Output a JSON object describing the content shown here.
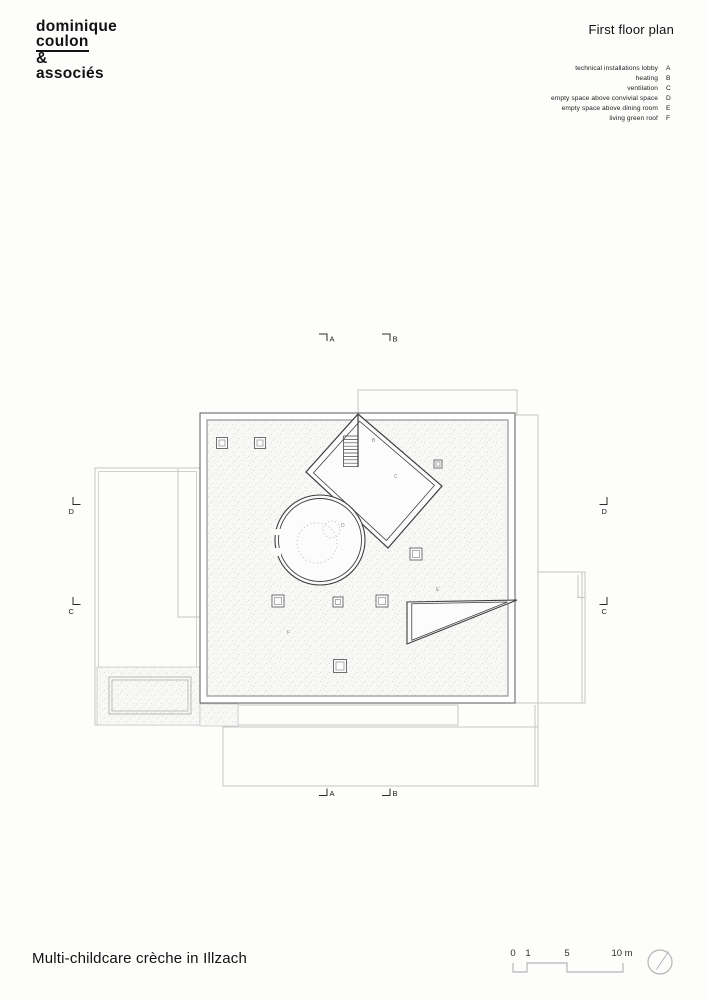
{
  "logo": {
    "lines": [
      "dominique",
      "coulon",
      "&",
      "associés"
    ]
  },
  "header": {
    "title": "First floor plan"
  },
  "legend": {
    "items": [
      {
        "label": "technical installations lobby",
        "key": "A"
      },
      {
        "label": "heating",
        "key": "B"
      },
      {
        "label": "ventilation",
        "key": "C"
      },
      {
        "label": "empty space above convivial space",
        "key": "D"
      },
      {
        "label": "empty space above dining room",
        "key": "E"
      },
      {
        "label": "living green roof",
        "key": "F"
      }
    ]
  },
  "plan": {
    "labels": {
      "b": "B",
      "c": "C",
      "d": "D",
      "e": "E",
      "f": "F"
    },
    "sections": {
      "top": [
        "A",
        "B"
      ],
      "bottom": [
        "A",
        "B"
      ],
      "left": [
        "D",
        "C"
      ],
      "right": [
        "D",
        "C"
      ]
    }
  },
  "scalebar": {
    "ticks": [
      "0",
      "1",
      "5",
      "10 m"
    ]
  },
  "footer": {
    "title": "Multi-childcare crèche in Illzach"
  },
  "colors": {
    "line_dark": "#3f3f3f",
    "line_mid": "#a2a2a2",
    "line_light": "#c5c5c5",
    "paper": "#fdfdfc"
  }
}
